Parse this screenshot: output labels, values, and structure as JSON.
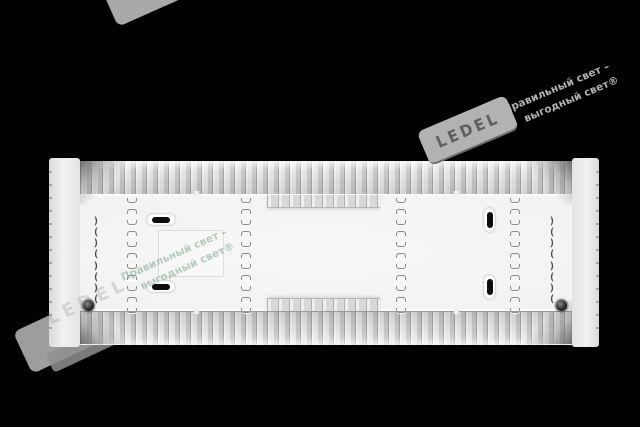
{
  "page": {
    "background_color": "#000000"
  },
  "watermarks": {
    "brand": "LEDEL",
    "tagline_line1": "Правильный свет –",
    "tagline_line2": "выгодный свет®",
    "gray_color": "#b2b2b2",
    "center_tagline_color": "rgba(124,168,136,0.55)"
  },
  "fixture": {
    "clip_glyph": ")("
  }
}
